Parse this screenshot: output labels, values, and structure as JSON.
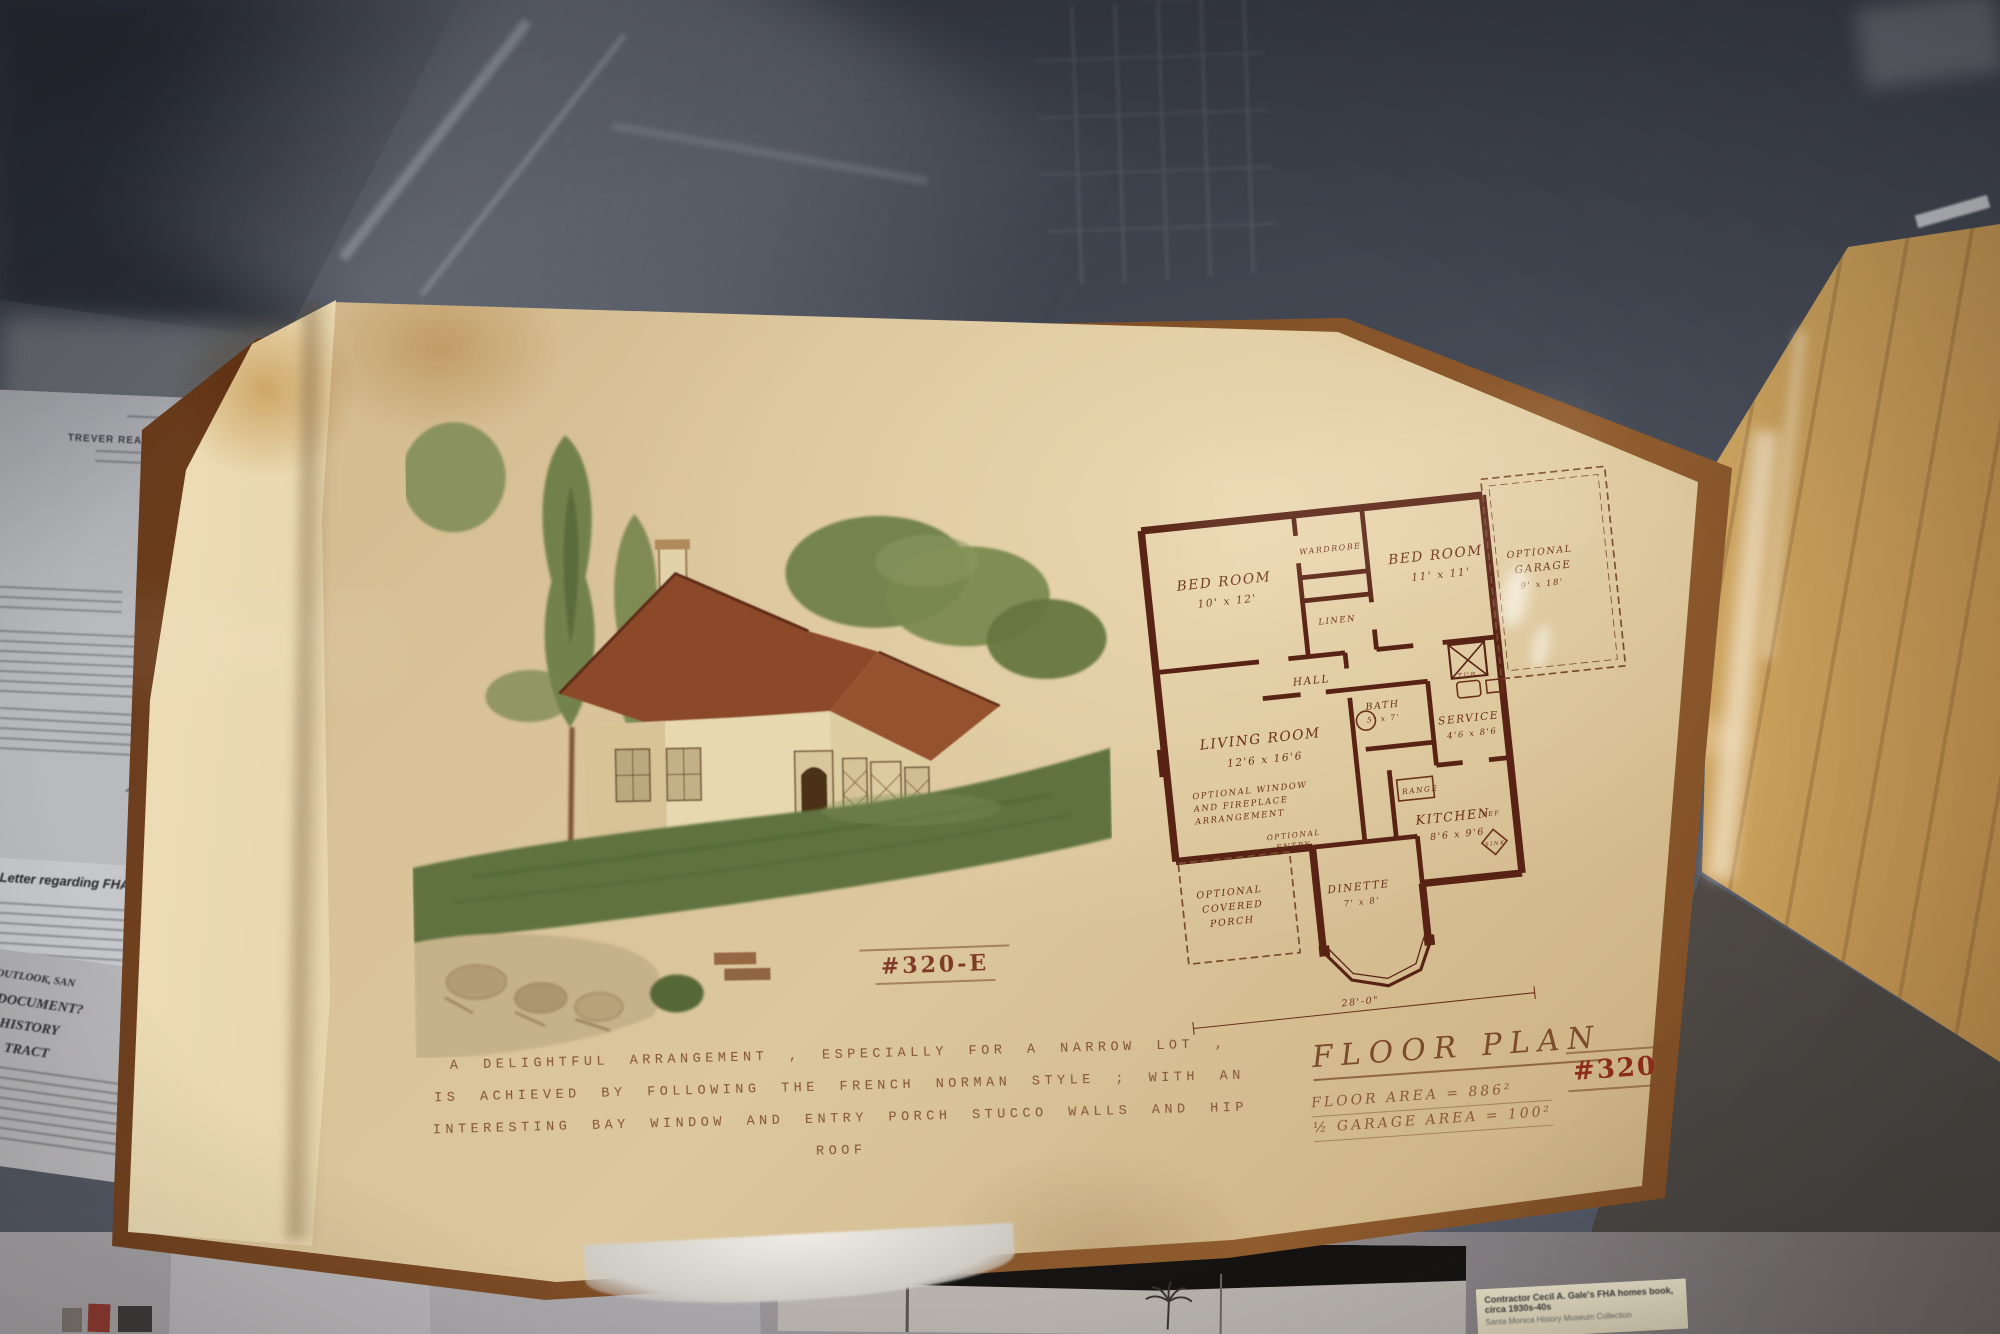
{
  "scene": {
    "description": "Museum display case: open FHA plan book with watercolor rendering of a French Norman style house (plate #320-E) beside its floor plan (#320); 1942 realty letter and newspaper clippings beneath glass",
    "colors": {
      "page_tan": "#d8c298",
      "plan_ink": "#6a3018",
      "wood_table": "#c2954f",
      "board_wood": "#7b4a24",
      "glass_gray": "#4a4f5a",
      "plate_red": "#8c2d1c"
    }
  },
  "letter": {
    "company": "TREVER REALTY COMPANY",
    "date": "June 12th, 1942."
  },
  "fha_label": {
    "title": "Letter regarding FHA home, 1942"
  },
  "clipping": {
    "lines": [
      "OUTLOOK, SAN",
      "DOCUMENT?",
      "HISTORY",
      "TRACT"
    ]
  },
  "plate": {
    "number": "#320-E",
    "caption_lines": [
      "A DELIGHTFUL ARRANGEMENT , ESPECIALLY FOR A NARROW LOT ,",
      "IS ACHIEVED BY FOLLOWING THE FRENCH NORMAN STYLE ; WITH AN",
      "INTERESTING BAY WINDOW AND ENTRY PORCH   STUCCO WALLS AND HIP ROOF"
    ],
    "floor_plan": {
      "title": "FLOOR PLAN",
      "area_line": "FLOOR AREA = 886²",
      "garage_area_line": "½ GARAGE AREA = 100²",
      "sheet_number": "#320",
      "overall_width": "28'-0\"",
      "rooms": {
        "bedroom1": {
          "name": "BED ROOM",
          "dims": "10' x 12'"
        },
        "wardrobe": {
          "name": "WARDROBE"
        },
        "bedroom2": {
          "name": "BED ROOM",
          "dims": "11' x 11'"
        },
        "linen": {
          "name": "LINEN"
        },
        "hall": {
          "name": "HALL"
        },
        "garage": {
          "line1": "OPTIONAL",
          "line2": "GARAGE",
          "dims": "9' x 18'"
        },
        "living": {
          "name": "LIVING ROOM",
          "dims": "12'6 x 16'6"
        },
        "living_note": [
          "OPTIONAL WINDOW",
          "AND FIREPLACE",
          "ARRANGEMENT"
        ],
        "bath": {
          "name": "BATH",
          "dims": "5' x 7'"
        },
        "tub": {
          "name": "TUB"
        },
        "service": {
          "name": "SERVICE",
          "dims": "4'6 x 8'6"
        },
        "range": {
          "name": "RANGE"
        },
        "kitchen": {
          "name": "KITCHEN",
          "dims": "8'6 x 9'6"
        },
        "ref": {
          "name": "REF"
        },
        "dinette": {
          "name": "DINETTE",
          "dims": "7' x 8'"
        },
        "sink": {
          "name": "SINK"
        },
        "porch": [
          "OPTIONAL",
          "COVERED",
          "PORCH"
        ],
        "entry": [
          "OPTIONAL",
          "ENTRY"
        ]
      }
    }
  },
  "credit_label": {
    "line1": "Contractor Cecil A. Gale's FHA homes book, circa 1930s-40s",
    "line2": "Santa Monica History Museum Collection"
  }
}
